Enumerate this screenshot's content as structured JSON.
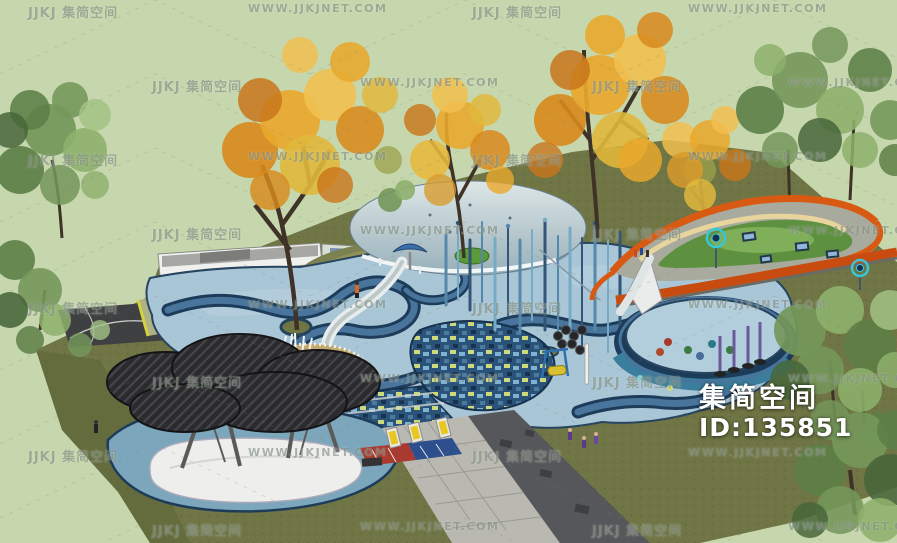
{
  "watermark": {
    "logo_text": "JJKJ 集简空间",
    "site_text": "WWW.JJKJNET.COM"
  },
  "brand_overlay": {
    "name": "集简空间",
    "id": "ID:135851"
  },
  "colors": {
    "background": "#c6d7ae",
    "grass": "#6f7544",
    "pool_deck": "#a9c6d7",
    "channel_dark": "#1d3c5a",
    "channel_water": "#49749c",
    "mosaic_base": "#2b5379",
    "dome_shell": "#c3d3d6",
    "mound_olive": "#8f9158",
    "ribbon_orange": "#d85a12",
    "ribbon_cream": "#e7d59d",
    "lawn_green": "#5d9140",
    "cloud_canopy": "#2b2b2e",
    "base_white": "#eeeeec",
    "pond_blue": "#7ca6bb",
    "path_grey": "#b9b9b2",
    "asphalt": "#56575b",
    "autumn_foliage": "#e8a82c",
    "tree_green": "#74975a",
    "watermark_text": "#7d897a",
    "overlay_text": "#ffffff"
  },
  "scene_elements": [
    "grass-field",
    "display-wall",
    "terraced-mound",
    "dome-canopy",
    "water-slide",
    "spray-poles",
    "pool-deck",
    "lazy-river-channel",
    "mosaic-pond",
    "orange-ribbon-track",
    "round-pool",
    "cloud-canopy",
    "wading-pool",
    "paved-path",
    "lounge-chairs",
    "autumn-tree",
    "green-tree"
  ]
}
